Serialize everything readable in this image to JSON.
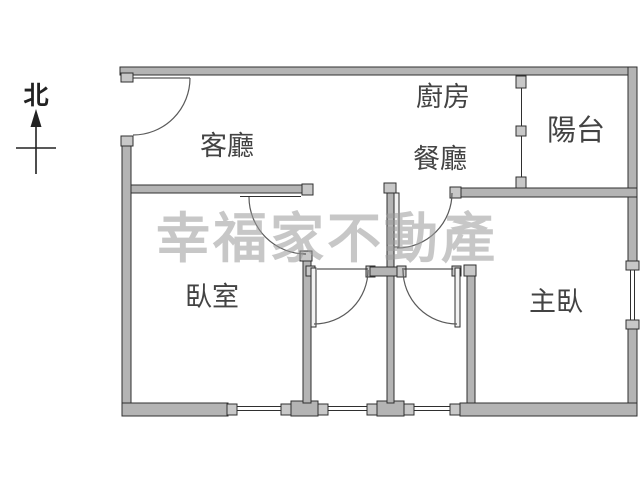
{
  "title": "apartment-floor-plan",
  "compass": {
    "label": "北"
  },
  "rooms": [
    {
      "id": "living",
      "label": "客廳"
    },
    {
      "id": "kitchen",
      "label": "廚房"
    },
    {
      "id": "dining",
      "label": "餐廳"
    },
    {
      "id": "balcony",
      "label": "陽台"
    },
    {
      "id": "bedroom",
      "label": "臥室"
    },
    {
      "id": "master",
      "label": "主臥"
    }
  ],
  "watermark": {
    "text": "幸福家不動產"
  },
  "colors": {
    "wall_fill": "#b4b4b4",
    "wall_outline": "#2f2f2f",
    "door_arc": "#5a5a5a",
    "label_text": "#434343",
    "watermark_gray": "#9b9b9b",
    "background": "#ffffff"
  }
}
